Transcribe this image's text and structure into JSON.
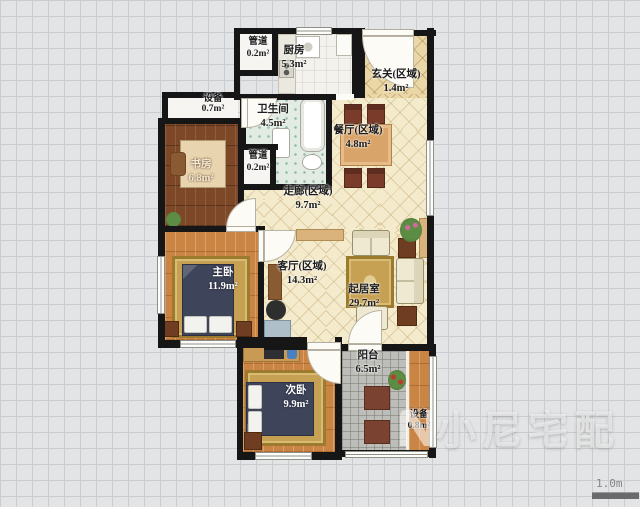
{
  "meta": {
    "watermark": "小尼宅配",
    "scale_label": "1.0m"
  },
  "rooms": [
    {
      "id": "pipe-top",
      "name": "管道",
      "area": "0.2m²"
    },
    {
      "id": "kitchen",
      "name": "厨房",
      "area": "5.3m²"
    },
    {
      "id": "entry-zone",
      "name": "玄关(区域)",
      "area": "1.4m²"
    },
    {
      "id": "equipment-top",
      "name": "设备",
      "area": "0.7m²"
    },
    {
      "id": "bathroom",
      "name": "卫生间",
      "area": "4.5m²"
    },
    {
      "id": "study",
      "name": "书房",
      "area": "6.8m²"
    },
    {
      "id": "pipe-mid",
      "name": "管道",
      "area": "0.2m²"
    },
    {
      "id": "corridor-zone",
      "name": "走廊(区域)",
      "area": "9.7m²"
    },
    {
      "id": "dining-zone",
      "name": "餐厅(区域)",
      "area": "4.8m²"
    },
    {
      "id": "master-bedroom",
      "name": "主卧",
      "area": "11.9m²"
    },
    {
      "id": "living-zone",
      "name": "客厅(区域)",
      "area": "14.3m²"
    },
    {
      "id": "living-room",
      "name": "起居室",
      "area": "29.7m²"
    },
    {
      "id": "second-bedroom",
      "name": "次卧",
      "area": "9.9m²"
    },
    {
      "id": "balcony",
      "name": "阳台",
      "area": "6.5m²"
    },
    {
      "id": "equipment-bottom",
      "name": "设备",
      "area": "0.8m²"
    }
  ],
  "colors": {
    "wall": "#161616",
    "floor_cream_tile": "#f4ebcd",
    "floor_entry_tile": "#ead7a8",
    "floor_wood_orange": "#ca8544",
    "floor_wood_dark": "#7d4827",
    "floor_bath_tile": "#e3ece2",
    "floor_balcony": "#bdbdb9",
    "bed_navy": "#3e4459",
    "rug_gold": "#c7a153",
    "furniture_brown": "#6e3d22",
    "grid_line": "#c9ccd0"
  }
}
